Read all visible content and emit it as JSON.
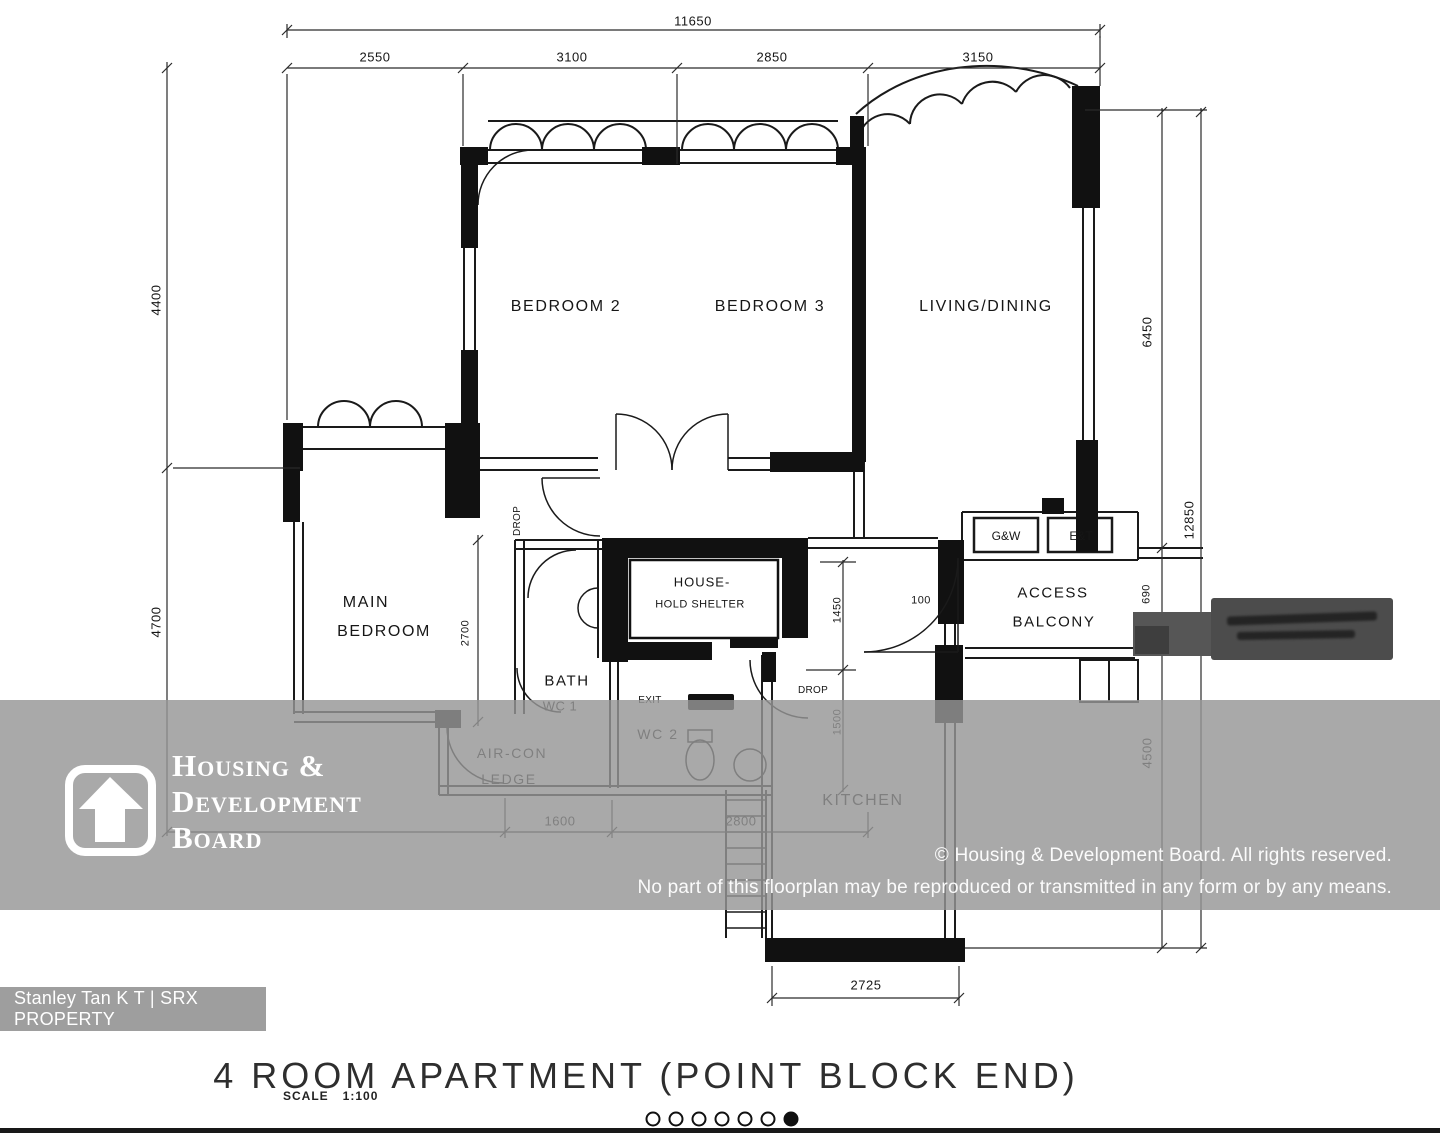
{
  "colors": {
    "wm": "#969696",
    "badge": "#9e9e9e",
    "ink": "#1a1a1a",
    "sign": "#4c4c4c"
  },
  "plan": {
    "rooms": {
      "bedroom2": "BEDROOM 2",
      "bedroom3": "BEDROOM 3",
      "living": "LIVING/DINING",
      "main_bedroom_line1": "MAIN",
      "main_bedroom_line2": "BEDROOM",
      "bath_line1": "BATH",
      "bath_line2": "WC 1",
      "wc2": "WC 2",
      "exit": "EXIT",
      "household_line1": "HOUSE-",
      "household_line2": "HOLD SHELTER",
      "aircon_line1": "AIR-CON",
      "aircon_line2": "LEDGE",
      "kitchen": "KITCHEN",
      "access_line1": "ACCESS",
      "access_line2": "BALCONY",
      "meter_gw": "G&W",
      "meter_et": "E&T",
      "level_mark": "100",
      "drop_upper": "DROP",
      "drop_kitchen": "DROP"
    },
    "dims": {
      "top_total": "11650",
      "top": [
        "2550",
        "3100",
        "2850",
        "3150"
      ],
      "left": [
        "4400",
        "4700"
      ],
      "right_inner": [
        "6450",
        "690",
        "4500"
      ],
      "right_total": "12850",
      "bath_v": "2700",
      "mid_v1": "1450",
      "mid_v2": "1500",
      "bottom": [
        "1600",
        "2800"
      ],
      "kitchen_bottom": "2725"
    }
  },
  "watermark": {
    "logo_line1": "Housing &",
    "logo_line2": "Development",
    "logo_line3": "Board",
    "copyright_line1": "© Housing & Development Board. All rights reserved.",
    "copyright_line2": "No part of this floorplan may be reproduced or transmitted in any form or by any means."
  },
  "agent_badge": {
    "text": "Stanley Tan K T | SRX PROPERTY"
  },
  "footer": {
    "title": "4 ROOM APARTMENT (POINT BLOCK END)",
    "scale_label": "SCALE",
    "scale_value": "1:100",
    "carousel": {
      "total": 7,
      "active_index": 6
    }
  }
}
